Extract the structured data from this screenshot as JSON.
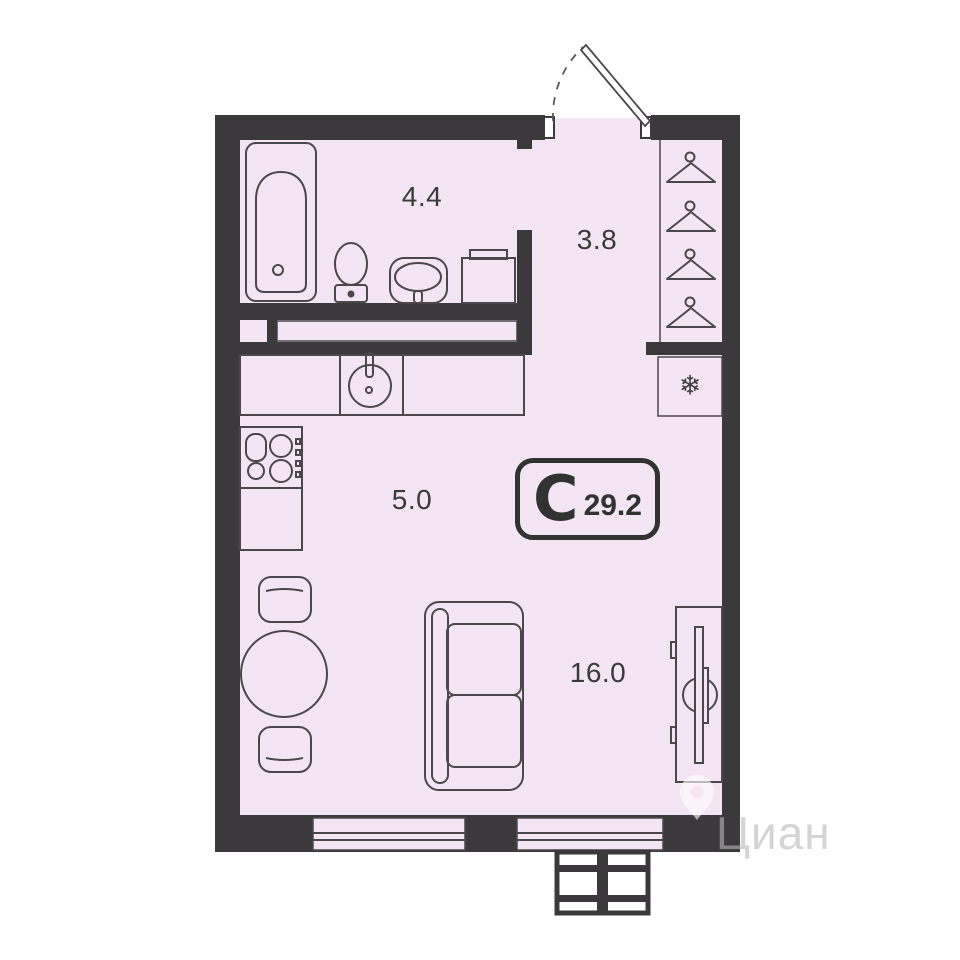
{
  "plan": {
    "badge": {
      "type_letter": "С",
      "total_area": "29.2"
    },
    "areas": {
      "bathroom": "4.4",
      "hallway": "3.8",
      "kitchen": "5.0",
      "living_room": "16.0"
    },
    "symbols": {
      "fridge": "❄"
    },
    "colors": {
      "wall": "#3b393c",
      "floor": "#f3e5f4",
      "furniture_line": "#4c474d",
      "label_text": "#3a3a3a",
      "badge": "#323232"
    }
  },
  "watermark": {
    "brand": "Циан"
  }
}
